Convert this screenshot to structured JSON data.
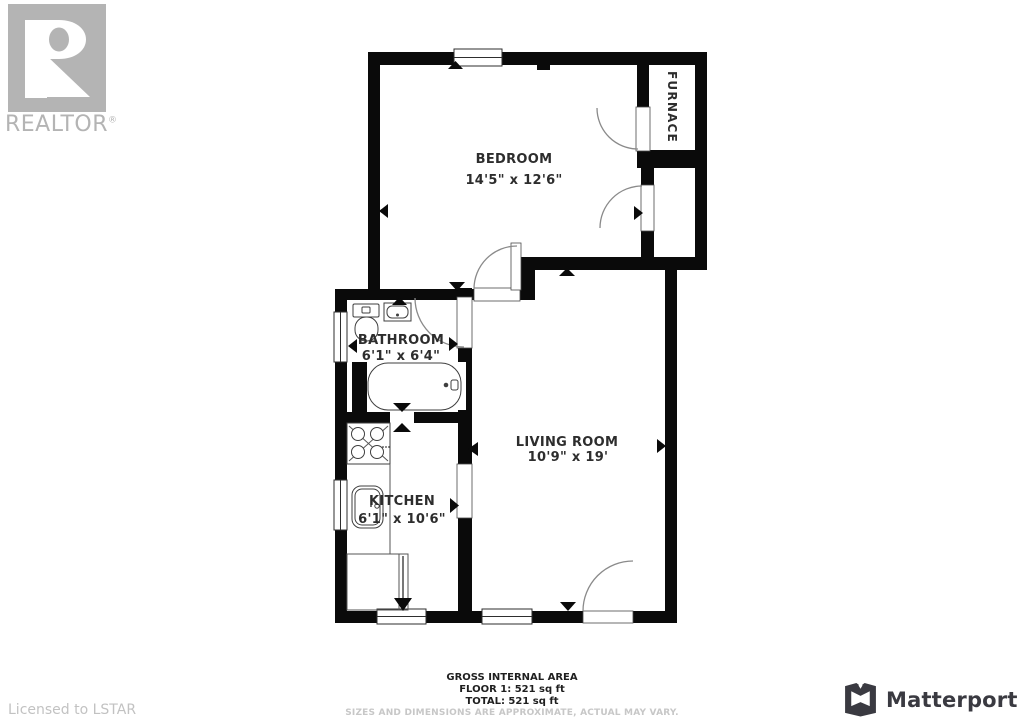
{
  "branding": {
    "realtor_logo": "REALTOR",
    "registered_mark": "®",
    "licensed": "Licensed to LSTAR",
    "matterport": "Matterport"
  },
  "floorplan": {
    "rooms": [
      {
        "name": "BEDROOM",
        "dimensions": "14'5\" x 12'6\""
      },
      {
        "name": "BATHROOM",
        "dimensions": "6'1\" x 6'4\""
      },
      {
        "name": "KITCHEN",
        "dimensions": "6'1\" x 10'6\""
      },
      {
        "name": "LIVING ROOM",
        "dimensions": "10'9\" x 19'"
      },
      {
        "name": "FURNACE",
        "dimensions": ""
      }
    ]
  },
  "footer": {
    "title": "GROSS INTERNAL AREA",
    "floor1": "FLOOR 1: 521 sq ft",
    "total": "TOTAL: 521 sq ft",
    "disclaimer": "SIZES AND DIMENSIONS ARE APPROXIMATE, ACTUAL MAY VARY."
  },
  "colors": {
    "wall": "#0a0a0a",
    "logo_gray": "#b4b4b4",
    "matterport_dark": "#3a3a41",
    "label_text": "#2d2d2d",
    "disclaimer_gray": "#c7c7c7"
  }
}
